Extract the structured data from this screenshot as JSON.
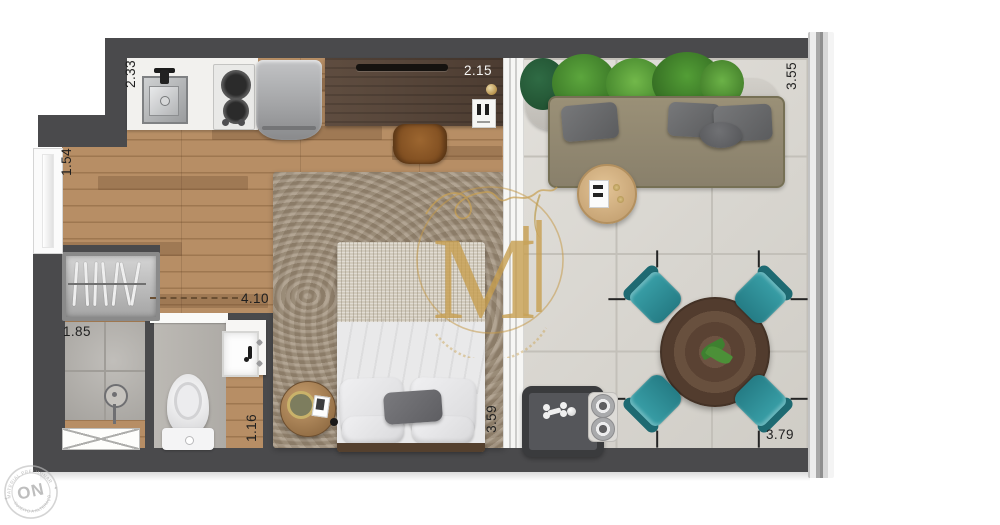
{
  "dimensions": {
    "kitchen": "2.33",
    "entry": "1.54",
    "desk_wall": "2.15",
    "balcony_side": "3.55",
    "room_width": "4.10",
    "shower": "1.85",
    "vanity": "1.16",
    "bedroom_glass": "3.59",
    "balcony_bottom": "3.79"
  },
  "watermark": {
    "monogram": "M"
  },
  "stamp": {
    "text": "ON",
    "arc_top": "MATERIAL PRELIMINAR",
    "arc_bottom": "SUJEITO A ALTERAÇÕES"
  },
  "colors": {
    "wall": "#4a4a4c",
    "wood_floor": "#b18a62",
    "balcony_tile": "#d8d5ce",
    "chair_teal": "#2f8e96",
    "sofa_olive": "#978d74",
    "gold": "#c49a4a"
  }
}
